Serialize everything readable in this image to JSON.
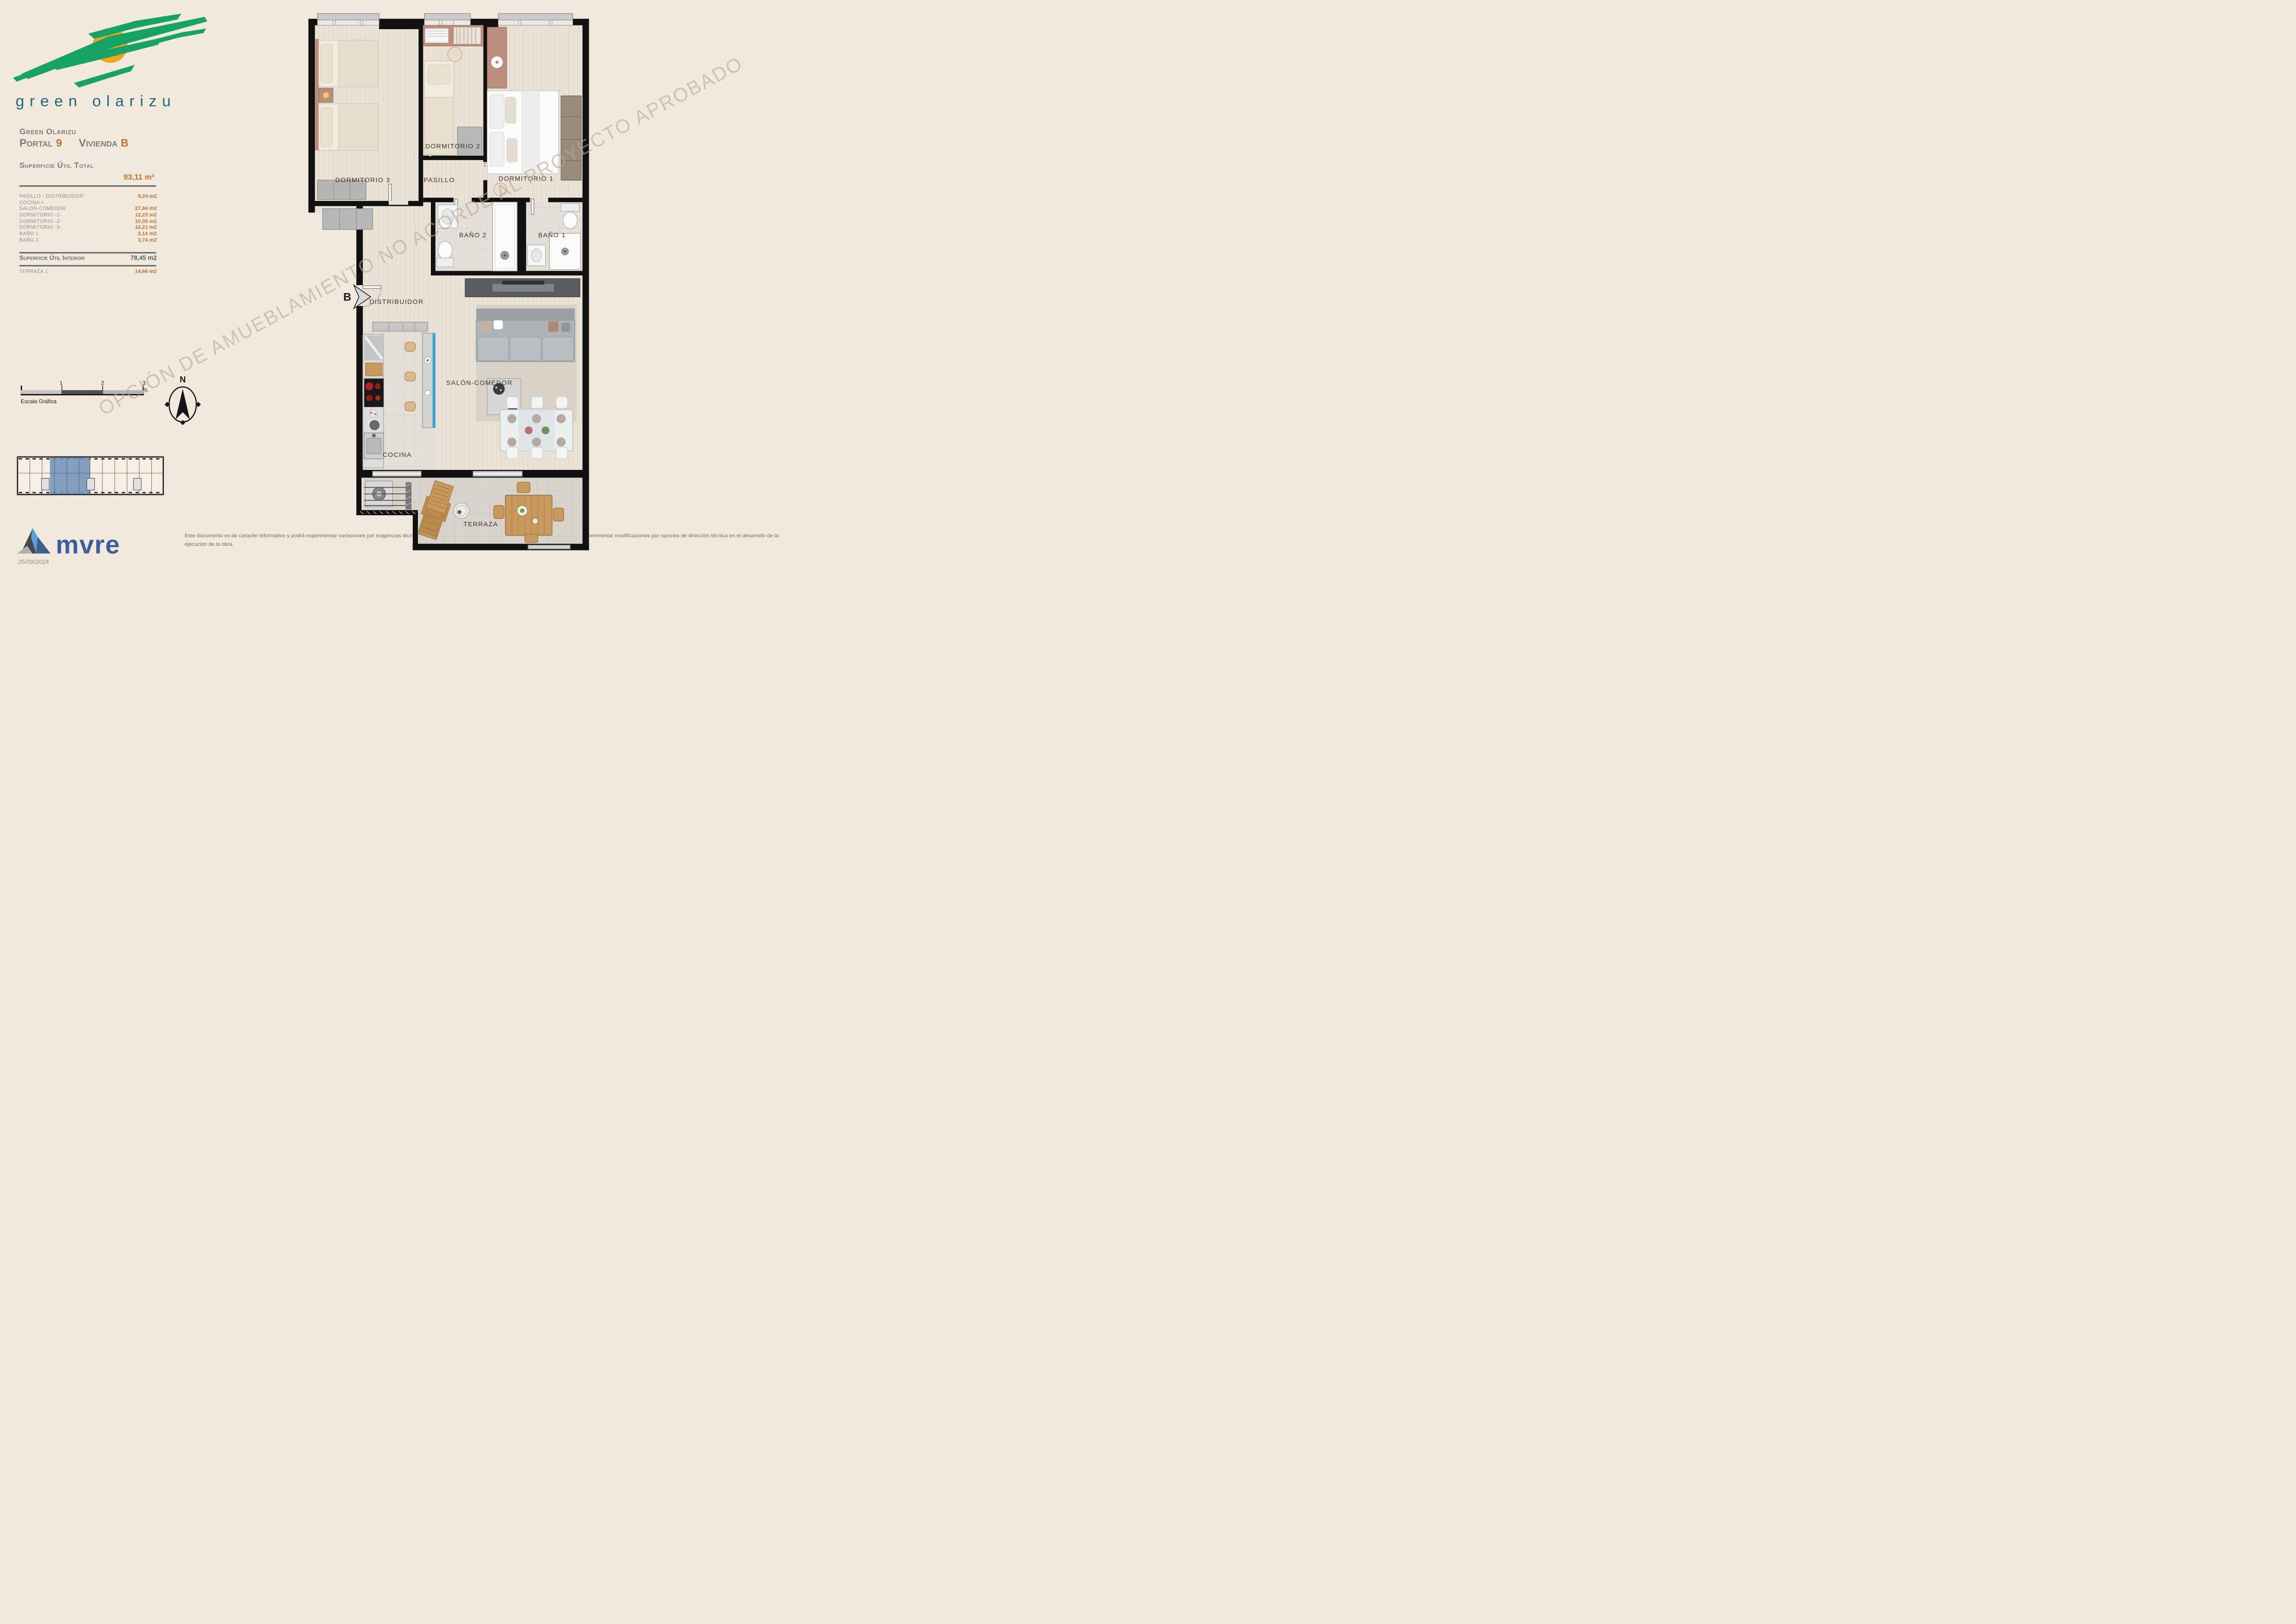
{
  "branding": {
    "logo_text": "green olarizu",
    "brand_green": "#17a266",
    "sun_orange": "#f2a51d",
    "logo_text_color": "#25647f"
  },
  "header": {
    "project": "Green Olarizu",
    "portal_label": "Portal",
    "portal_number": "9",
    "vivienda_label": "Vivienda",
    "vivienda_letter": "B"
  },
  "surface": {
    "total_label": "Superficie Útil Total",
    "total_value": "93,11 m²",
    "rows": [
      {
        "label": "PASILLO - DISTRIBUIDOR",
        "value": "9,24 m2"
      },
      {
        "label": "COCINA +",
        "value": ""
      },
      {
        "label": "SALON-COMEDOR",
        "value": "27,84 m2"
      },
      {
        "label": "DORMITORIO -1-",
        "value": "12,23 m2"
      },
      {
        "label": "DORMITORIO -2-",
        "value": "10,05 m2"
      },
      {
        "label": "DORMITORIO -3-",
        "value": "12,21 m2"
      },
      {
        "label": "BAÑO 1",
        "value": "3,14 m2"
      },
      {
        "label": "BAÑO 2",
        "value": "3,74 m2"
      }
    ],
    "interior_label": "Superficie Útil Interior",
    "interior_value": "78,45 m2",
    "terrace_label": "TERRAZA 1",
    "terrace_value": "14,66 m2"
  },
  "scalebar": {
    "tick1": "1",
    "tick2": "2",
    "tick3": "3 m.",
    "caption": "Escala Gráfica"
  },
  "compass": {
    "north": "N"
  },
  "plan": {
    "entrance_label": "B",
    "rooms": [
      {
        "label": "DORMITORIO 3"
      },
      {
        "label": "DORMITORIO 2"
      },
      {
        "label": "DORMITORIO 1"
      },
      {
        "label": "PASILLO"
      },
      {
        "label": "BAÑO 2"
      },
      {
        "label": "BAÑO 1"
      },
      {
        "label": "DISTRIBUIDOR"
      },
      {
        "label": "SALÓN-COMEDOR"
      },
      {
        "label": "COCINA"
      },
      {
        "label": "TERRAZA"
      }
    ]
  },
  "watermark": {
    "text": "OPCIÓN DE AMUEBLAMIENTO NO ACORDE AL PROYECTO APROBADO"
  },
  "footer": {
    "brand": "mvre",
    "brand_color": "#3c5da0",
    "date": "25/09/2024",
    "disclaimer": "Este documento es de caracter informativo y podrá experimentar variaciones por exigencias técnicas del proyecto. Las superficies expresadas son aproximadas, podrán experimentar modificaciones por razones de dirección técnica en el desarrollo de la ejecución de la obra."
  },
  "colors": {
    "background": "#f2e9dd",
    "accent_orange": "#c8702f",
    "text_gray": "#8a8a8a",
    "wall": "#111111",
    "highlight_unit": "#7195bb",
    "bar_accent": "#2fa7d4"
  }
}
